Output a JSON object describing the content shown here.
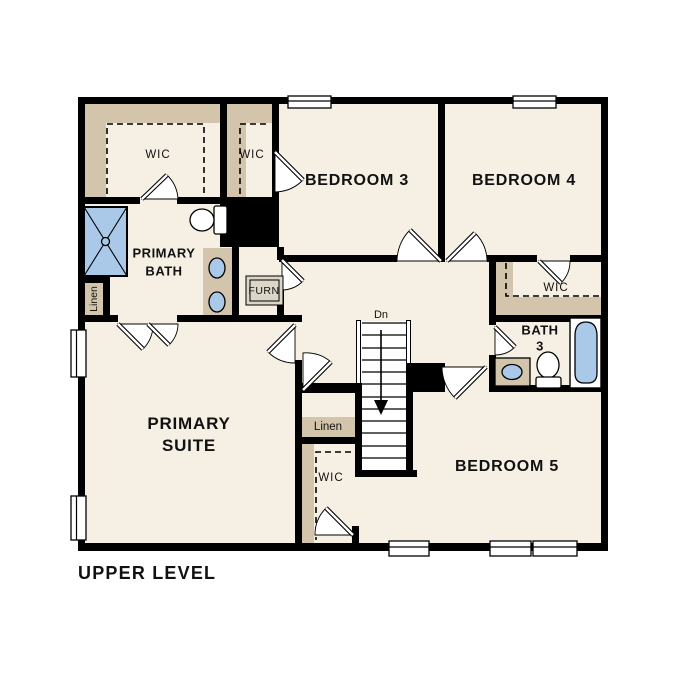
{
  "title": "UPPER LEVEL",
  "colors": {
    "paper": "#ffffff",
    "floor": "#f6efe3",
    "shelf": "#d2c5ac",
    "fixture": "#aac9e8",
    "wall": "#000000",
    "appliance": "#dcd6c8"
  },
  "labels": {
    "primary_wic": "WIC",
    "bedroom3_wic": "WIC",
    "bedroom4_wic": "WIC",
    "bedroom5_wic": "WIC",
    "bedroom3": "BEDROOM 3",
    "bedroom4": "BEDROOM 4",
    "bedroom5": "BEDROOM 5",
    "primary_bath": [
      "PRIMARY",
      "BATH"
    ],
    "primary_suite": [
      "PRIMARY",
      "SUITE"
    ],
    "bath3": [
      "BATH",
      "3"
    ],
    "linen_bath": "Linen",
    "linen_hall": "Linen",
    "furnace": "FURN",
    "stair_direction": "Dn"
  }
}
